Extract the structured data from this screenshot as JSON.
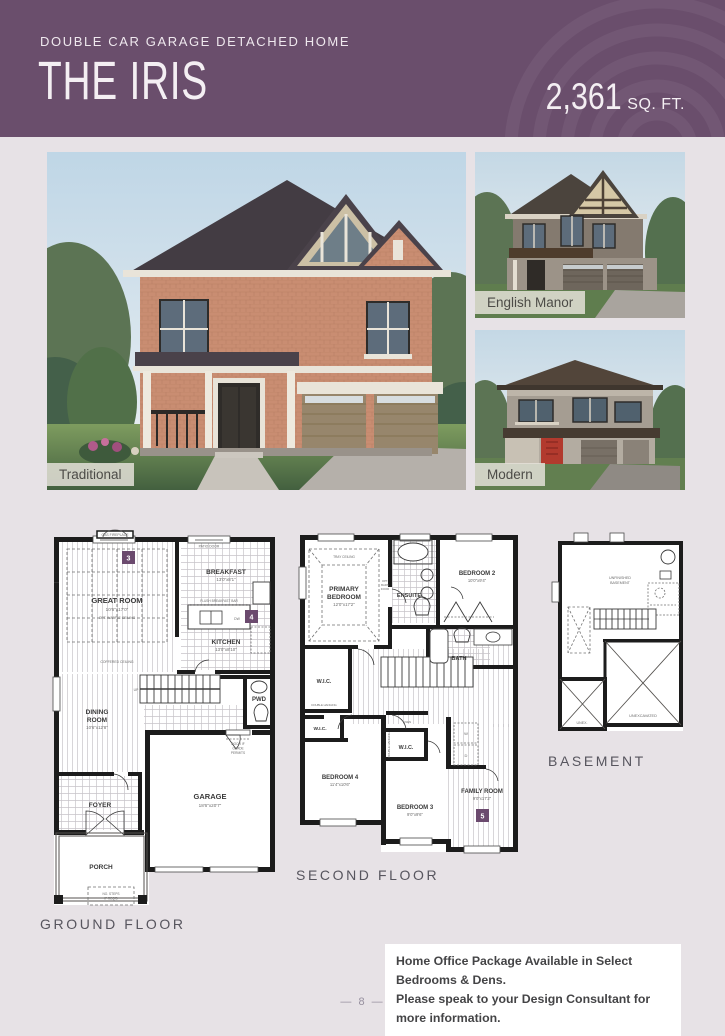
{
  "header": {
    "subtitle": "DOUBLE CAR GARAGE DETACHED HOME",
    "title": "THE IRIS",
    "sqft_number": "2,361",
    "sqft_unit": "SQ. FT.",
    "bg_color": "#6a4e6c"
  },
  "elevations": {
    "traditional_label": "Traditional",
    "english_manor_label": "English Manor",
    "modern_label": "Modern"
  },
  "floorplans": {
    "marker_color": "#6b4a6e",
    "ground": {
      "title": "GROUND FLOOR",
      "marker3": "3",
      "marker4": "4",
      "gas_fireplace": "GAS FIREPLACE",
      "patio_door": "PATIO DOOR",
      "great_room": {
        "name": "GREAT ROOM",
        "dims": "10'6\"x17'0\"",
        "note1": "OPT. WAFFLE CEILING",
        "note2": "COFFERED CEILING"
      },
      "breakfast": {
        "name": "BREAKFAST",
        "dims": "13'0\"x8'1\""
      },
      "flush_bar": "FLUSH BREAKFAST BAR",
      "dw": "DW",
      "kitchen": {
        "name": "KITCHEN",
        "dims": "13'0\"x8'10\""
      },
      "pwd": "PWD",
      "up": "UP",
      "dining": {
        "name1": "DINING",
        "name2": "ROOM",
        "dims": "10'6\"x12'8\""
      },
      "foyer": "FOYER",
      "garage": {
        "name": "GARAGE",
        "dims": "18'6\"x20'7\""
      },
      "porch": "PORCH",
      "door_grade1": "DOOR IF",
      "door_grade2": "GRADE",
      "door_grade3": "PERMITS",
      "steps1": "NO. STEPS",
      "steps2": "IF REQ'D"
    },
    "second": {
      "title": "SECOND FLOOR",
      "marker5": "5",
      "tray_ceiling": "TRAY CEILING",
      "primary": {
        "name1": "PRIMARY",
        "name2": "BEDROOM",
        "dims": "12'0\"x17'2\""
      },
      "opt_barn1": "OPT.",
      "opt_barn2": "BARN",
      "opt_barn3": "DOOR",
      "ensuite": "ENSUITE",
      "bedroom2": {
        "name": "BEDROOM 2",
        "dims": "10'0\"x9'4\""
      },
      "bath": "BATH",
      "wic": "W.I.C.",
      "linen": "LINEN",
      "double_hanging": "DOUBLE HANGING",
      "bedroom4": {
        "name": "BEDROOM 4",
        "dims": "11'4\"x10'6\""
      },
      "bedroom3": {
        "name": "BEDROOM 3",
        "dims": "9'0\"x9'6\""
      },
      "family": {
        "name": "FAMILY ROOM",
        "dims": "9'0\"x17'2\""
      },
      "w": "W",
      "d": "D"
    },
    "basement": {
      "title": "BASEMENT",
      "unfinished1": "UNFINISHED",
      "unfinished2": "BASEMENT",
      "unexcavated": "UNEXCAVATED",
      "unex": "UNEX."
    }
  },
  "note": {
    "line1": "Home Office Package Available in Select Bedrooms & Dens.",
    "line2": "Please speak to your Design Consultant for more information."
  },
  "footer": {
    "dash": "—",
    "page_number": "8"
  }
}
